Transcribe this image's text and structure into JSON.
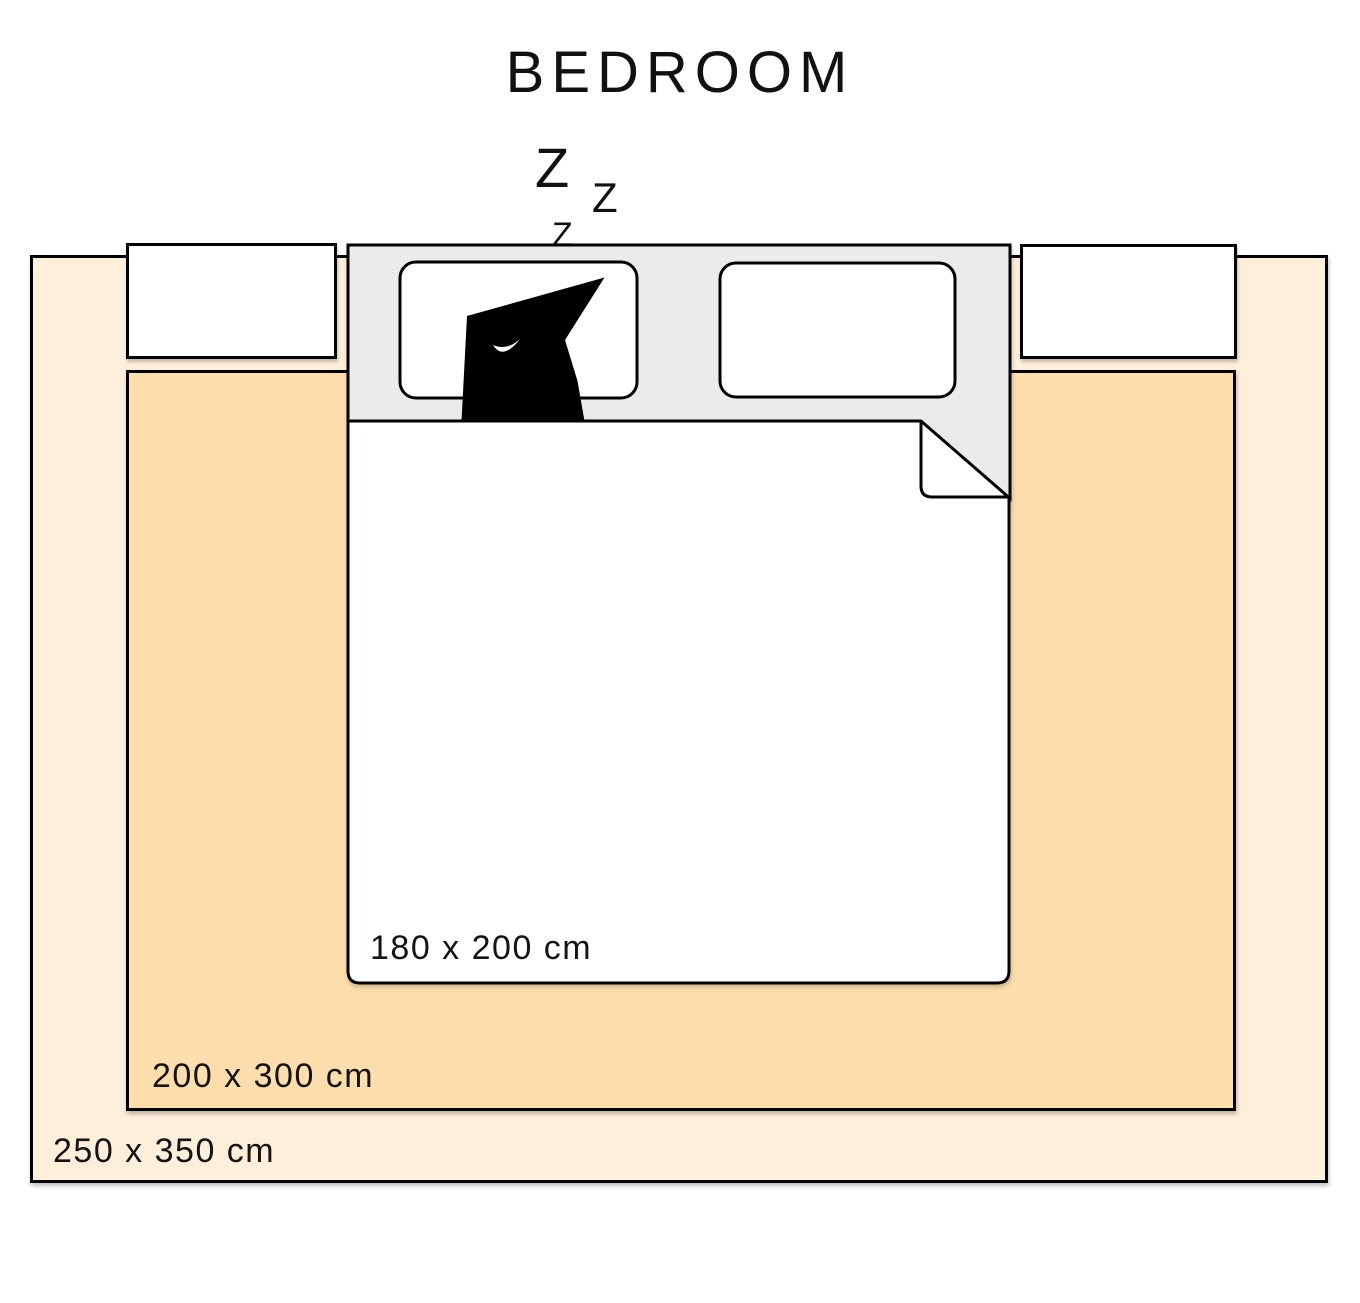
{
  "title": "BEDROOM",
  "snore_letters": [
    "Z",
    "Z",
    "Z"
  ],
  "bed": {
    "size_label": "180 x 200 cm",
    "mattress_color": "#EBEBEB",
    "duvet_color": "#FFFFFF",
    "pillow_color": "#FFFFFF",
    "cat_color": "#000000"
  },
  "rugs": [
    {
      "name": "large-rug",
      "size_label": "250 x 350 cm",
      "color": "#FEEFDB"
    },
    {
      "name": "medium-rug",
      "size_label": "200 x 300 cm",
      "color": "#FDDEAC"
    }
  ],
  "outline_color": "#000000",
  "background_color": "#FFFFFF"
}
